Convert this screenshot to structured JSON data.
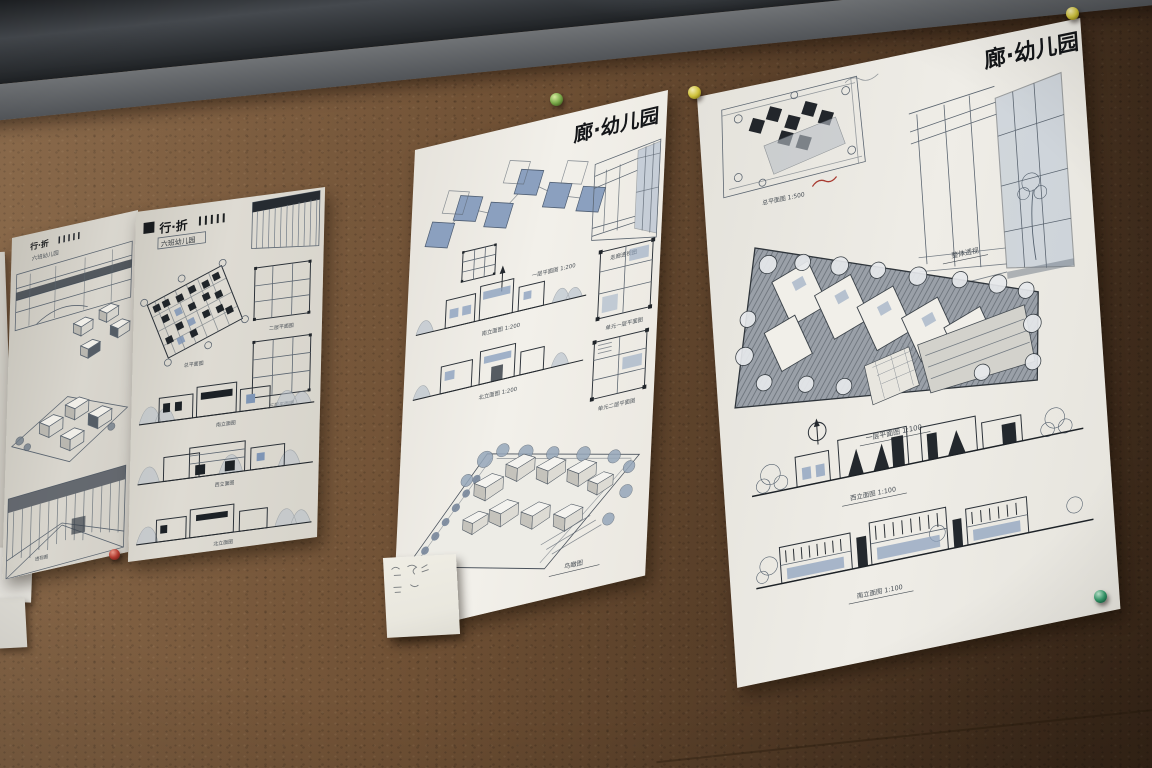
{
  "scene": {
    "description": "Photograph of four hand-drawn kindergarten architecture presentation posters pinned to a brown cork board, below a dark wall rail",
    "cork_color": "#6b4c31",
    "rail_color": "#24282c",
    "drawing_accent_blue": "#8ca1bf"
  },
  "posters": {
    "p1": {
      "title": "行·折",
      "subtitle": "六班幼儿园",
      "captions": {
        "perspective": "透视图"
      }
    },
    "p2": {
      "title": "行·折",
      "subtitle": "六班幼儿园",
      "captions": {
        "site": "总平面图",
        "plan2": "二层平面图",
        "plan3": "三层平面图",
        "elev1": "南立面图",
        "elev2": "西立面图",
        "elev3": "北立面图"
      }
    },
    "p3": {
      "title": "廊·幼儿园",
      "captions": {
        "plan": "一层平面图 1:200",
        "corridor": "走廊透视图",
        "unit1": "单元一层平面图",
        "unit2": "单元二层平面图",
        "elev1": "南立面图 1:200",
        "elev2": "北立面图 1:200",
        "bird": "鸟瞰图"
      }
    },
    "p4": {
      "title": "廊·幼儿园",
      "captions": {
        "site": "总平面图 1:500",
        "persp": "整体透视",
        "plan": "一层平面图 1:100",
        "elev_west": "西立面图 1:100",
        "elev_south": "南立面图 1:100"
      }
    }
  },
  "pins": {
    "green_top": "#79a94a",
    "yellow_left": "#cfc23c",
    "yellow_right": "#cfc23c",
    "green_bottom": "#35996b",
    "red": "#b23b30"
  }
}
